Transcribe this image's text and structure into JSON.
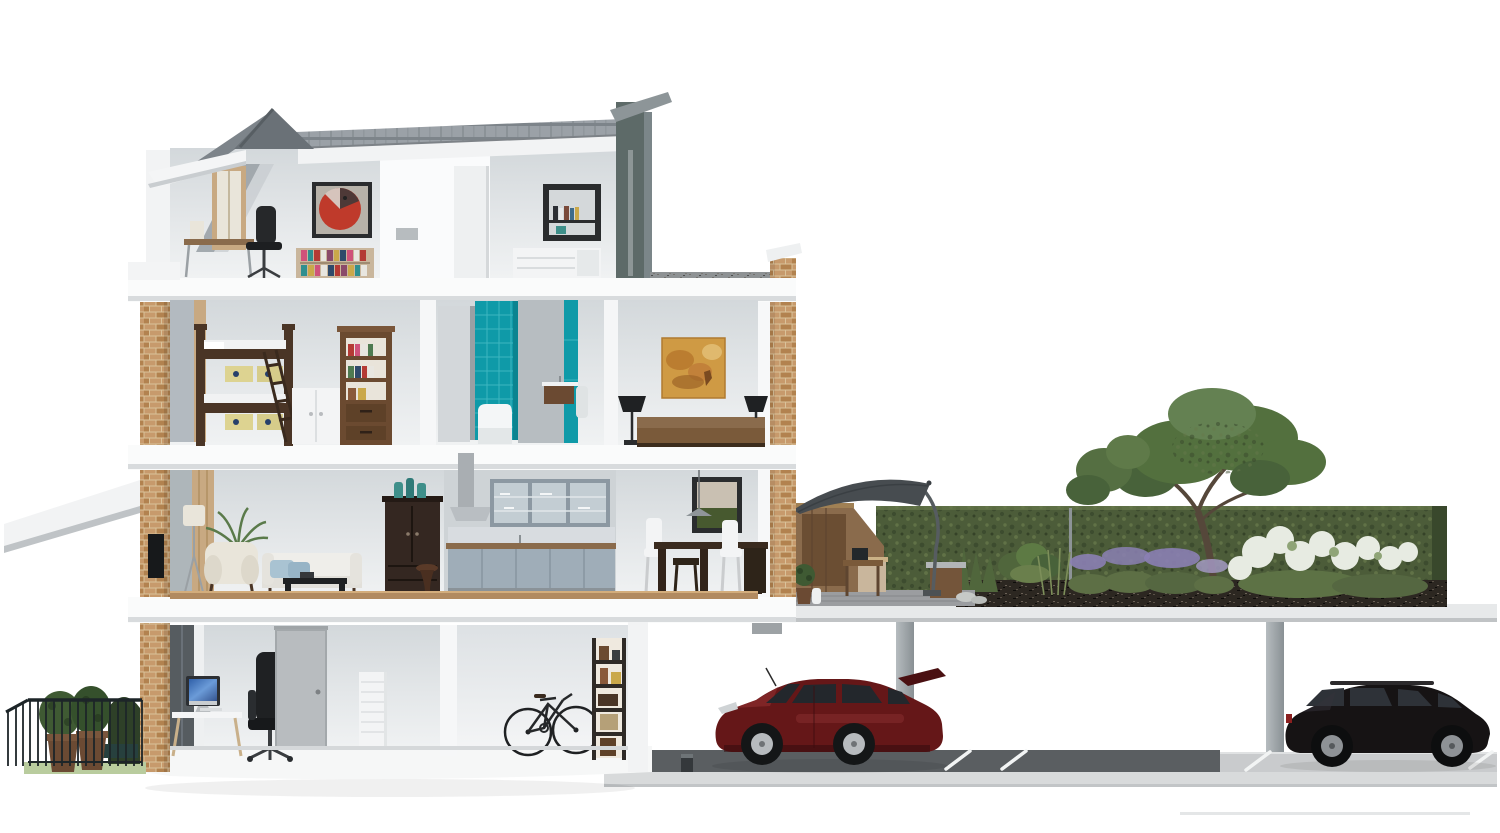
{
  "scene": {
    "title": "Cutaway cross-section of a four-storey townhouse with roof-terrace garden and underground car park",
    "building": {
      "floors": [
        {
          "id": "attic",
          "rooms": [
            "attic-studio",
            "attic-bedroom"
          ],
          "items": [
            "dormer-window",
            "writing-desk",
            "task-chair",
            "red-abstract-artwork",
            "low-bookcase",
            "box-shelf",
            "white-dresser",
            "chimney"
          ]
        },
        {
          "id": "second-floor",
          "rooms": [
            "kids-bedroom",
            "bathroom",
            "master-bedroom"
          ],
          "items": [
            "bunk-bed",
            "bunk-ladder",
            "white-cabinet",
            "tall-bookcase",
            "teal-tiled-shower",
            "bathtub",
            "floating-vanity",
            "towel",
            "orange-abstract-painting",
            "double-bed",
            "table-lamp-left",
            "table-lamp-right"
          ]
        },
        {
          "id": "first-floor",
          "rooms": [
            "living-room",
            "kitchen",
            "dining-room"
          ],
          "items": [
            "floor-lamp",
            "palm-plant",
            "cream-armchair",
            "white-sofa",
            "blue-cushions",
            "coffee-table",
            "dark-armoire",
            "teal-bottles",
            "range-hood",
            "glass-upper-cabinets",
            "base-cabinets",
            "wood-counter",
            "framed-landscape-picture",
            "pendant-lamp",
            "dining-table",
            "white-dining-chairs",
            "stool"
          ]
        },
        {
          "id": "ground-floor",
          "rooms": [
            "home-office",
            "storage-room"
          ],
          "items": [
            "white-desk",
            "desktop-computer",
            "black-office-chair",
            "grey-internal-door",
            "white-drawer-unit",
            "bicycle",
            "ladder-shelf"
          ]
        }
      ],
      "facade": [
        "brick-piers",
        "slate-roof",
        "dormer-gable",
        "flat-roof-parapet",
        "foundation"
      ]
    },
    "front_garden": {
      "items": [
        "iron-railing",
        "timber-planters",
        "shrubs",
        "topiary-arch",
        "bench",
        "grass"
      ]
    },
    "roof_garden": {
      "items": [
        "timber-store",
        "cantilever-parasol",
        "patio-heater",
        "potted-topiary",
        "timber-table",
        "planter-box",
        "clipped-hedge",
        "ferns",
        "ornamental-grasses",
        "lavender",
        "white-hydrangeas",
        "garden-tree",
        "soil-profile",
        "decking"
      ]
    },
    "car_park": {
      "items": [
        "concrete-roof-slab",
        "concrete-columns",
        "asphalt-lane",
        "parking-bay-lines",
        "foundation-strip",
        "bollard"
      ],
      "cars": [
        {
          "id": "red-hatchback",
          "facing": "left"
        },
        {
          "id": "black-estate",
          "facing": "right"
        }
      ]
    }
  },
  "palette": {
    "bg": "#ffffff",
    "wall_top": "#d5d9dc",
    "wall_bottom": "#eff1f2",
    "slab": "#fafbfb",
    "slab_shadow": "#d8dbdd",
    "roof_tile": "#9ba1a7",
    "roof_tile_dark": "#7d848a",
    "roof_gable": "#6a7177",
    "chimney": "#5d6a68",
    "brick": "#c79a6c",
    "brick_dark": "#b2824f",
    "brick_mortar": "#d9c29a",
    "window_tan": "#c8a982",
    "teal": "#0f9aa8",
    "teal_light": "#3db6c0",
    "art_red": "#bf3a2b",
    "art_frame": "#2a2c2e",
    "art_orange": "#cf9a44",
    "art_orange_dark": "#b5762c",
    "wood_dark": "#4a3526",
    "wood_mid": "#7a5a3a",
    "wood_warm": "#8a6b4c",
    "wood_pale": "#c9b69c",
    "floor_wood": "#b18a60",
    "cream": "#e9e5da",
    "sofa_white": "#efeeea",
    "pillow_blue": "#a9c3d2",
    "black_furn": "#1f2123",
    "armoire": "#342721",
    "kitchen_wall": "#ced3d6",
    "cabinet_blue": "#9fadb8",
    "cabinet_glass": "#c3cdd3",
    "steel": "#b9bec2",
    "picture_green": "#47592f",
    "picture_sky": "#c9c0b2",
    "screen_blue": "#3f6fb5",
    "door_grey": "#b8bcbf",
    "white_furn": "#f3f4f5",
    "hedge": "#4c5c39",
    "hedge_dark": "#39482c",
    "hedge_light": "#66784a",
    "tree": "#53703e",
    "tree_light": "#648152",
    "trunk": "#55473a",
    "soil": "#2c2721",
    "lavender": "#8b80b4",
    "hydrangea": "#e7ebe2",
    "leaf_green": "#50663c",
    "deck": "#9b9da0",
    "umbrella": "#474c50",
    "concrete": "#c9cbcd",
    "concrete_light": "#d8dadb",
    "asphalt": "#5a5e61",
    "column": "#a7adb0",
    "line_white": "#f2f4f4",
    "car_red": "#651718",
    "car_red_hi": "#8d2d2e",
    "car_black": "#161314",
    "glass": "#23272c",
    "rim_silver": "#b7bbbe",
    "fence": "#1d2528",
    "grass": "#b9cc9e",
    "planter": "#6b4a33",
    "shrub": "#3f5a33"
  }
}
